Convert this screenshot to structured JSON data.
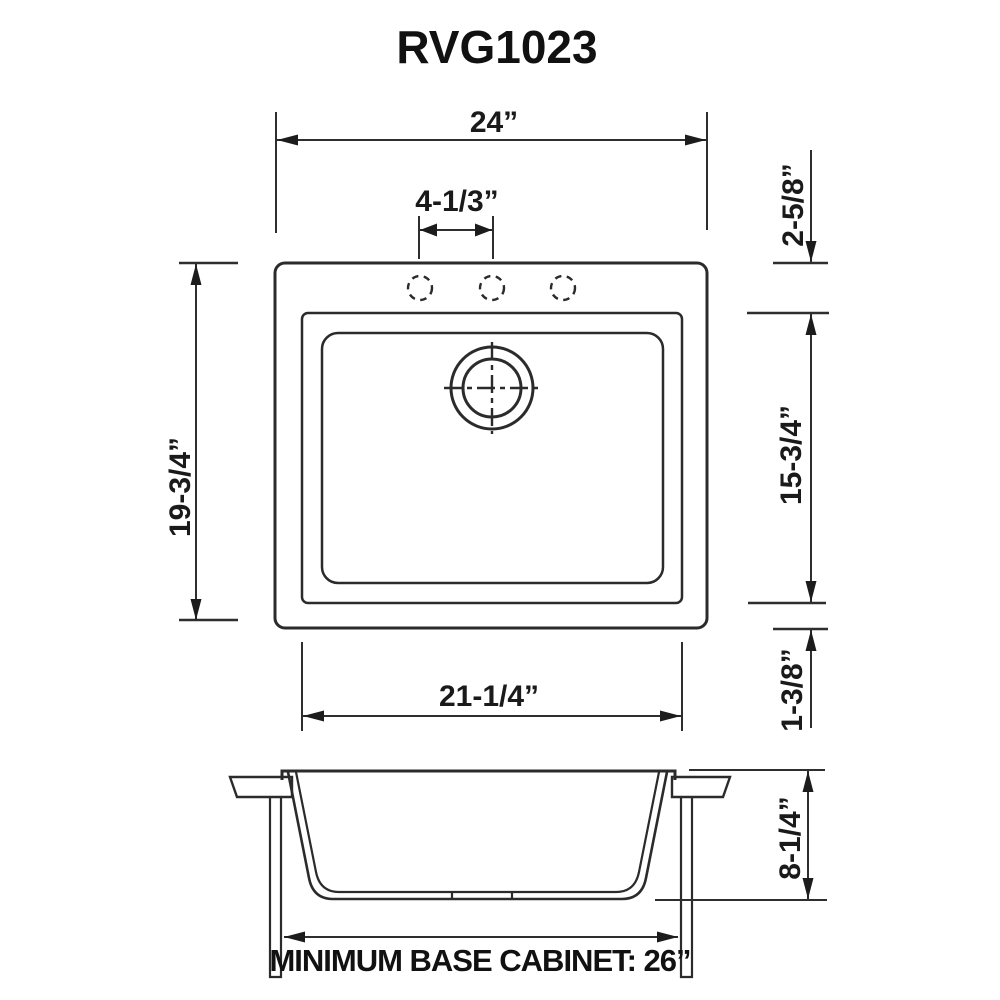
{
  "title": "RVG1023",
  "top_view": {
    "dim_overall_width": "24”",
    "dim_faucet_hole_spacing": "4-1/3”",
    "dim_overall_depth": "19-3/4”",
    "dim_rim_top": "2-5/8”",
    "dim_bowl_depth_front_back": "15-3/4”",
    "dim_rim_bottom": "1-3/8”",
    "dim_bowl_width": "21-1/4”"
  },
  "front_view": {
    "dim_bowl_height": "8-1/4”",
    "cabinet_note": "MINIMUM BASE CABINET: 26”"
  }
}
